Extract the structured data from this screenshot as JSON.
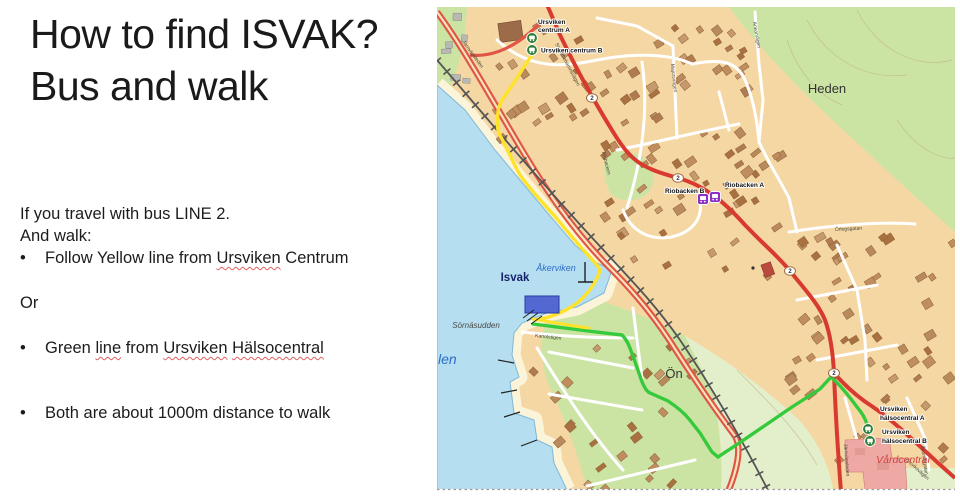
{
  "slide": {
    "title1": "How to find ISVAK?",
    "title2": "Bus and walk",
    "intro1": "If you travel with bus LINE 2.",
    "intro2": "And walk:",
    "bullet_char": "•",
    "b1_pre": "Follow Yellow line from ",
    "b1_u": "Ursviken",
    "b1_post": " Centrum",
    "or_label": "Or",
    "b2_pre": "Green ",
    "b2_u1": "line",
    "b2_m1": " from ",
    "b2_u2": "Ursviken",
    "b2_m2": " ",
    "b2_u3": "Hälsocentral",
    "b3": "Both are about 1000m distance to walk"
  },
  "map": {
    "badge": "2",
    "places": {
      "heden": "Heden",
      "on": "Ön",
      "isvak": "Isvak",
      "akerviken": "Åkerviken",
      "sornasudden": "Sörnäsudden",
      "fjarden": "len",
      "vardcentral": "Vårdcentral"
    },
    "streets": {
      "jarnvagsleden": "Järnvägsleden",
      "skelleftehamnsvagen": "Skelleftehamnsvägen",
      "riobacken": "Riobacken",
      "majorsvagen": "Majorsvägen",
      "ankarvagen": "Ankarvägen",
      "orlogsgatan": "Örlogsgatan",
      "kanotstigen": "Kanotstigen",
      "ursviksvagen": "Ursviksvägen",
      "asundsgatan": "Åsundsgatan"
    },
    "stops": {
      "centrum_a_l1": "Ursviken",
      "centrum_a_l2": "centrum A",
      "centrum_b": "Ursviken centrum B",
      "riobacken_b": "Riobacken B",
      "riobacken_a": "Riobacken A",
      "halso_a_l1": "Ursviken",
      "halso_a_l2": "hälsocentral A",
      "halso_b_l1": "Ursviken",
      "halso_b_l2": "hälsocentral B"
    },
    "colors": {
      "water": "#b5def0",
      "land": "#f5d7a3",
      "forest": "#cbe4a4",
      "field": "#e3efcb",
      "sand": "#fcf4d9",
      "road_red": "#d93a2f",
      "road_red_light": "#e05545",
      "route_yellow": "#ffe32b",
      "route_green": "#35c93c",
      "stop_green": "#2f7f36",
      "stop_purple": "#8e2fc7"
    }
  }
}
